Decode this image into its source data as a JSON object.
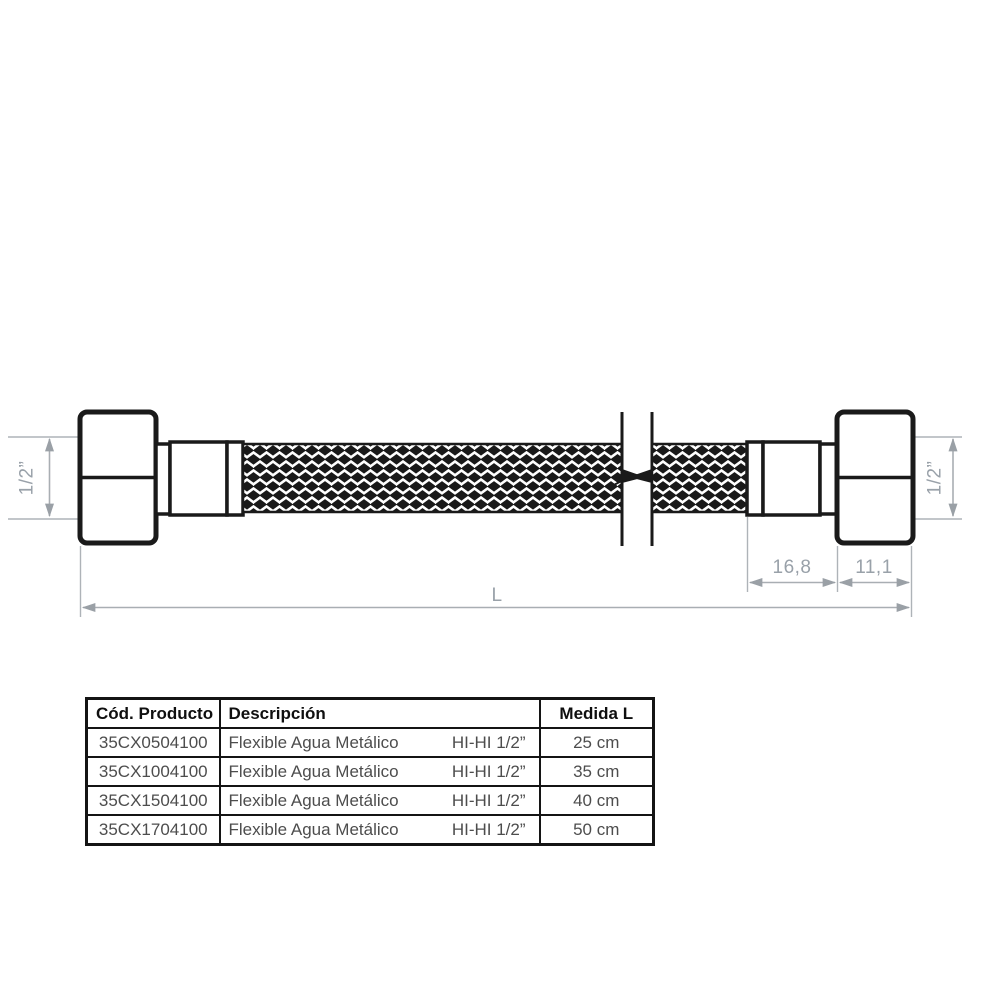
{
  "drawing": {
    "left_thread_dim": "1/2”",
    "right_thread_dim": "1/2”",
    "collar_length_dim": "16,8",
    "nut_length_dim": "11,1",
    "total_length_dim": "L"
  },
  "table": {
    "headers": {
      "code": "Cód. Producto",
      "description": "Descripción",
      "measure": "Medida L"
    },
    "rows": [
      {
        "code": "35CX0504100",
        "description": "Flexible Agua Metálico",
        "spec": "HI-HI 1/2”",
        "measure": "25 cm"
      },
      {
        "code": "35CX1004100",
        "description": "Flexible Agua Metálico",
        "spec": "HI-HI 1/2”",
        "measure": "35 cm"
      },
      {
        "code": "35CX1504100",
        "description": "Flexible Agua Metálico",
        "spec": "HI-HI 1/2”",
        "measure": "40 cm"
      },
      {
        "code": "35CX1704100",
        "description": "Flexible Agua Metálico",
        "spec": "HI-HI 1/2”",
        "measure": "50 cm"
      }
    ]
  },
  "colors": {
    "drawing_line": "#1a1a1a",
    "dimension_gray": "#99a1a9",
    "table_border": "#141414",
    "table_text": "#4d4d4d"
  }
}
